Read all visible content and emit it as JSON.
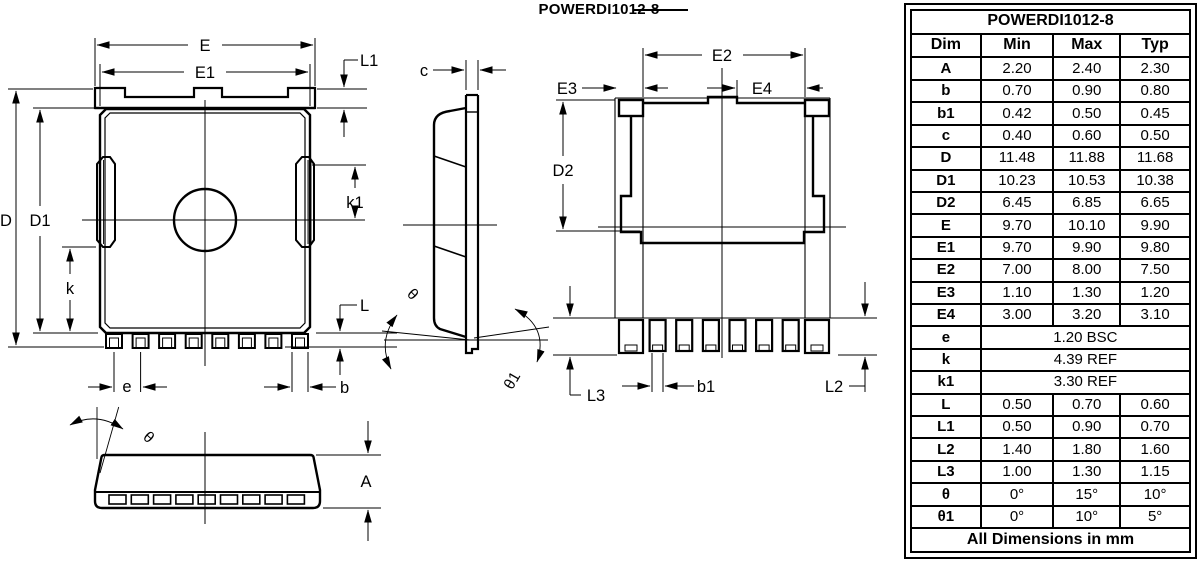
{
  "title": "POWERDI1012-8",
  "drawing": {
    "view_back": {
      "E": "E",
      "E1": "E1",
      "L1": "L1",
      "D": "D",
      "D1": "D1",
      "k": "k",
      "k1": "k1",
      "L": "L",
      "e": "e",
      "b": "b"
    },
    "view_side": {
      "c": "c",
      "theta": "θ",
      "theta1": "θ1"
    },
    "view_bottom": {
      "E2": "E2",
      "E3": "E3",
      "E4": "E4",
      "D2": "D2",
      "b1": "b1",
      "L2": "L2",
      "L3": "L3"
    },
    "view_profile": {
      "theta": "θ",
      "A": "A"
    }
  },
  "table": {
    "title": "POWERDI1012-8",
    "headers": {
      "dim": "Dim",
      "min": "Min",
      "max": "Max",
      "typ": "Typ"
    },
    "rows": [
      {
        "dim": "A",
        "min": "2.20",
        "max": "2.40",
        "typ": "2.30"
      },
      {
        "dim": "b",
        "min": "0.70",
        "max": "0.90",
        "typ": "0.80"
      },
      {
        "dim": "b1",
        "min": "0.42",
        "max": "0.50",
        "typ": "0.45"
      },
      {
        "dim": "c",
        "min": "0.40",
        "max": "0.60",
        "typ": "0.50"
      },
      {
        "dim": "D",
        "min": "11.48",
        "max": "11.88",
        "typ": "11.68"
      },
      {
        "dim": "D1",
        "min": "10.23",
        "max": "10.53",
        "typ": "10.38"
      },
      {
        "dim": "D2",
        "min": "6.45",
        "max": "6.85",
        "typ": "6.65"
      },
      {
        "dim": "E",
        "min": "9.70",
        "max": "10.10",
        "typ": "9.90"
      },
      {
        "dim": "E1",
        "min": "9.70",
        "max": "9.90",
        "typ": "9.80"
      },
      {
        "dim": "E2",
        "min": "7.00",
        "max": "8.00",
        "typ": "7.50"
      },
      {
        "dim": "E3",
        "min": "1.10",
        "max": "1.30",
        "typ": "1.20"
      },
      {
        "dim": "E4",
        "min": "3.00",
        "max": "3.20",
        "typ": "3.10"
      },
      {
        "dim": "e",
        "span": "1.20 BSC"
      },
      {
        "dim": "k",
        "span": "4.39 REF"
      },
      {
        "dim": "k1",
        "span": "3.30 REF"
      },
      {
        "dim": "L",
        "min": "0.50",
        "max": "0.70",
        "typ": "0.60"
      },
      {
        "dim": "L1",
        "min": "0.50",
        "max": "0.90",
        "typ": "0.70"
      },
      {
        "dim": "L2",
        "min": "1.40",
        "max": "1.80",
        "typ": "1.60"
      },
      {
        "dim": "L3",
        "min": "1.00",
        "max": "1.30",
        "typ": "1.15"
      },
      {
        "dim": "θ",
        "min": "0°",
        "max": "15°",
        "typ": "10°"
      },
      {
        "dim": "θ1",
        "min": "0°",
        "max": "10°",
        "typ": "5°"
      }
    ],
    "footer": "All Dimensions in mm"
  }
}
